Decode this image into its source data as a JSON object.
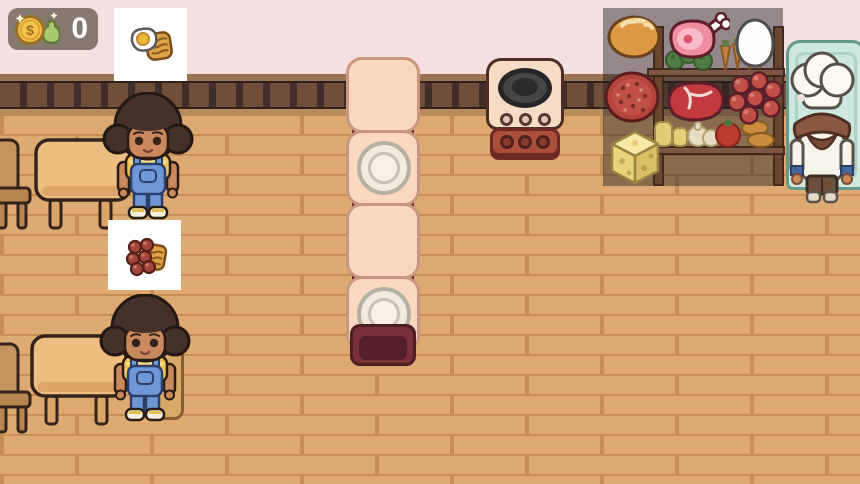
{
  "hud": {
    "money": {
      "currency_symbol": "$",
      "value": "0"
    }
  },
  "orders": [
    {
      "card": "order-card-1",
      "item": "fried_egg_and_hash_brown"
    },
    {
      "card": "order-card-2",
      "item": "meatballs_and_hash_brown"
    }
  ],
  "customers": [
    {
      "id": "customer-1",
      "appearance": "afro_yellow_shirt_blue_overalls"
    },
    {
      "id": "customer-2",
      "appearance": "afro_yellow_shirt_blue_overalls"
    }
  ],
  "staff": [
    {
      "id": "chef",
      "appearance": "white_chef_hat_brown_scarf"
    }
  ],
  "furniture": {
    "tables": 2,
    "chairs": 3,
    "counter_segments": 4,
    "plates_on_counter": 2
  },
  "kitchen": {
    "stove_burners": 1,
    "stove_knobs": 3,
    "fridge": "mint_refrigerator"
  },
  "pantry_items": [
    "bread",
    "ham",
    "egg",
    "salami",
    "steak",
    "meatballs",
    "cheese"
  ],
  "shelf_produce": [
    "broccoli",
    "carrots",
    "butter",
    "garlic",
    "tomato",
    "croissants"
  ],
  "palette": {
    "wall": "#f5dfe0",
    "wall_band": "#422e28",
    "floor": "#dfaa71",
    "floor_seam": "#c48e55",
    "counter": "#f8d8c0",
    "counter_base": "#6a2430",
    "order_card": "#ffffff",
    "money_panel": "#7d7268",
    "fridge": "#cde8de",
    "overlay": "rgba(33,30,35,0.45)"
  }
}
